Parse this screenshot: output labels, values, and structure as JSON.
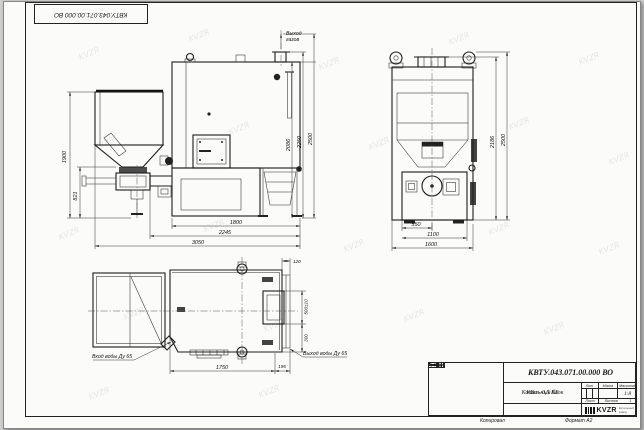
{
  "corner_stamp": {
    "doc_number": "КВТУ.043.071.00.000 ВО"
  },
  "title_block": {
    "doc_number": "КВТУ.043.071.00.000 ВО",
    "name_line1": "Котельный блок",
    "name_line2": "КВа - 0,5 КБ",
    "lit_header": "Лит.",
    "mass_header": "Масса",
    "scale_header": "Масштаб",
    "scale_value": "1:8",
    "sheet_header": "Лист",
    "sheets_header": "Листов",
    "sheets_value": "1",
    "change_cols": {
      "izm": "Изм.",
      "list": "Лист",
      "doc": "№ докум.",
      "podp": "Подп.",
      "data": "Дата"
    },
    "sig_rows": {
      "r1": "Разраб.",
      "r2": "Пров.",
      "r3": "Т.контр.",
      "r4": "Н.контр.",
      "r5": "Утв."
    },
    "logo_text": "KVZR",
    "logo_sub1": "Котельный",
    "logo_sub2": "завод"
  },
  "footer": {
    "copied": "Копировал",
    "format": "Формат А2"
  },
  "front_view": {
    "gas_out_1": "Выход",
    "gas_out_2": "газов",
    "dim_h_hopper": "1900",
    "dim_h_feeder": "821",
    "dim_h_body": "2086",
    "dim_h_flange": "2250",
    "dim_h_total": "2500",
    "dim_w_body": "1800",
    "dim_w_feeder": "2245",
    "dim_w_total": "3050"
  },
  "side_view": {
    "dim_h_inner": "2186",
    "dim_h_total": "2500",
    "dim_w_center": "550",
    "dim_w_lower": "1100",
    "dim_w_total": "1600"
  },
  "plan_view": {
    "water_in": "Вход воды Ду 65",
    "water_out": "Выход воды Ду 65",
    "dim_top": "120",
    "dim_flue": "500±10",
    "dim_offset": "300",
    "dim_length": "1750",
    "dim_stub": "195"
  },
  "watermark": "KVZR"
}
